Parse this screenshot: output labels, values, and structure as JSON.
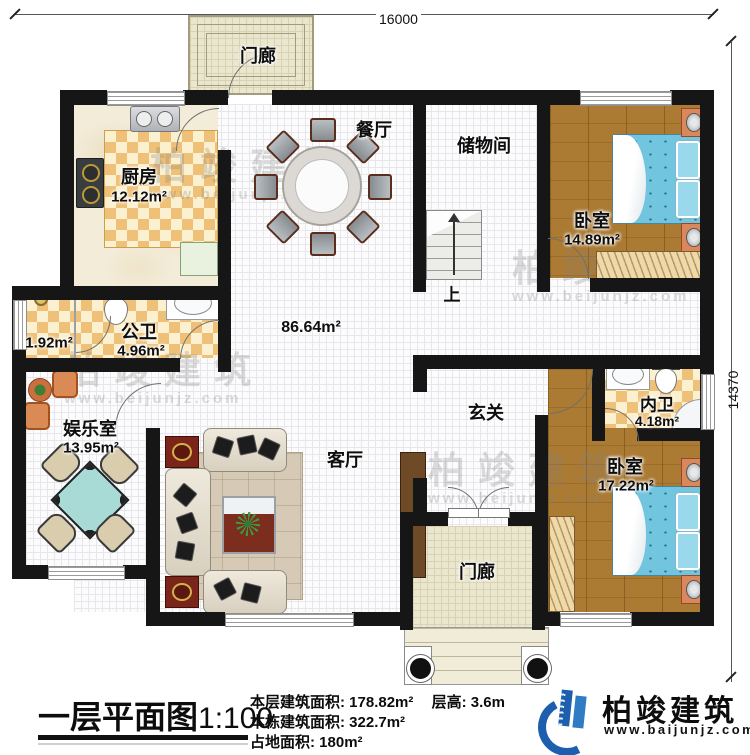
{
  "dimensions": {
    "top": "16000",
    "right": "14370"
  },
  "rooms": {
    "porch_top": {
      "label": "门廊"
    },
    "kitchen": {
      "label": "厨房",
      "area": "12.12m²"
    },
    "dining": {
      "label": "餐厅"
    },
    "storage": {
      "label": "储物间"
    },
    "bedroom1": {
      "label": "卧室",
      "area": "14.89m²"
    },
    "bath_public": {
      "label": "公卫",
      "area": "4.96m²",
      "shower_area": "1.92m²"
    },
    "entertainment": {
      "label": "娱乐室",
      "area": "13.95m²"
    },
    "great_room_area": "86.64m²",
    "stairs_up": "上",
    "foyer": {
      "label": "玄关"
    },
    "living": {
      "label": "客厅"
    },
    "bath_master": {
      "label": "内卫",
      "area": "4.18m²"
    },
    "bedroom2": {
      "label": "卧室",
      "area": "17.22m²"
    },
    "porch_bottom": {
      "label": "门廊"
    }
  },
  "title_block": {
    "title": "一层平面图",
    "scale": "1:100",
    "stats": [
      {
        "label": "本层建筑面积:",
        "value": "178.82m²"
      },
      {
        "label": "本栋建筑面积:",
        "value": "322.7m²"
      },
      {
        "label": "占地面积:",
        "value": "180m²"
      }
    ],
    "floor_height": {
      "label": "层高:",
      "value": "3.6m"
    }
  },
  "logo": {
    "name": "柏竣建筑",
    "url": "www.baijunjz.com"
  },
  "watermark": {
    "name": "柏竣建筑",
    "url": "www.beijunjz.com"
  },
  "colors": {
    "wall": "#161616",
    "wood_floor": "#ab7a33",
    "bed_blue": "#72c5df",
    "checker_gold": "#efc077",
    "porch_beige": "#ebe6ce",
    "logo_blue": "#1d5fae"
  }
}
